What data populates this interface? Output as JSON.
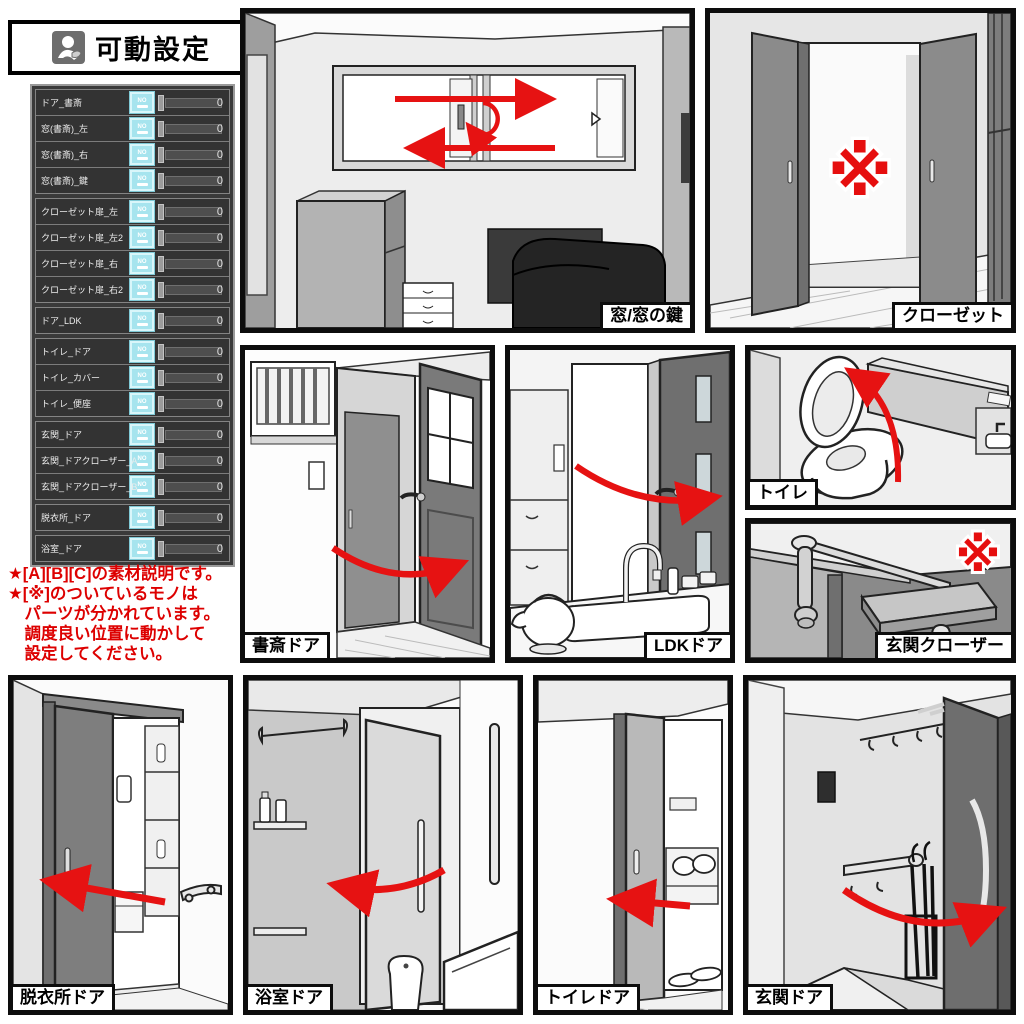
{
  "header": {
    "title": "可動設定"
  },
  "sliders": {
    "no_label": "NO",
    "groups": [
      {
        "rows": [
          {
            "label": "ドア_書斎",
            "value": "0"
          },
          {
            "label": "窓(書斎)_左",
            "value": "0"
          },
          {
            "label": "窓(書斎)_右",
            "value": "0"
          },
          {
            "label": "窓(書斎)_鍵",
            "value": "0"
          }
        ]
      },
      {
        "rows": [
          {
            "label": "クローゼット扉_左",
            "value": "0"
          },
          {
            "label": "クローゼット扉_左2",
            "value": "0"
          },
          {
            "label": "クローゼット扉_右",
            "value": "0"
          },
          {
            "label": "クローゼット扉_右2",
            "value": "0"
          }
        ]
      },
      {
        "rows": [
          {
            "label": "ドア_LDK",
            "value": "0"
          }
        ]
      },
      {
        "rows": [
          {
            "label": "トイレ_ドア",
            "value": "0"
          },
          {
            "label": "トイレ_カバー",
            "value": "0"
          },
          {
            "label": "トイレ_便座",
            "value": "0"
          }
        ]
      },
      {
        "rows": [
          {
            "label": "玄関_ドア",
            "value": "0"
          },
          {
            "label": "玄関_ドアクローザー_A",
            "value": "0"
          },
          {
            "label": "玄関_ドアクローザー_B",
            "value": "0"
          }
        ]
      },
      {
        "rows": [
          {
            "label": "脱衣所_ドア",
            "value": "0"
          }
        ]
      },
      {
        "rows": [
          {
            "label": "浴室_ドア",
            "value": "0"
          }
        ]
      }
    ]
  },
  "notes": {
    "lines": [
      "★[A][B][C]の素材説明です。",
      "★[※]のついているモノは",
      "　パーツが分かれています。",
      "　調度良い位置に動かして",
      "　設定してください。"
    ],
    "color": "#dd0000"
  },
  "panels": {
    "window": {
      "caption": "窓/窓の鍵"
    },
    "closet": {
      "caption": "クローゼット",
      "annotation": "※"
    },
    "study_door": {
      "caption": "書斎ドア"
    },
    "ldk_door": {
      "caption": "LDKドア"
    },
    "toilet": {
      "caption": "トイレ"
    },
    "door_closer": {
      "caption": "玄関クローザー",
      "annotation": "※"
    },
    "dressing_door": {
      "caption": "脱衣所ドア"
    },
    "bath_door": {
      "caption": "浴室ドア"
    },
    "toilet_door": {
      "caption": "トイレドア"
    },
    "entrance_door": {
      "caption": "玄関ドア"
    }
  },
  "colors": {
    "accent_red": "#e61212",
    "button_cyan": "#a6e4ee",
    "panel_dark": "#3a3a3a"
  }
}
